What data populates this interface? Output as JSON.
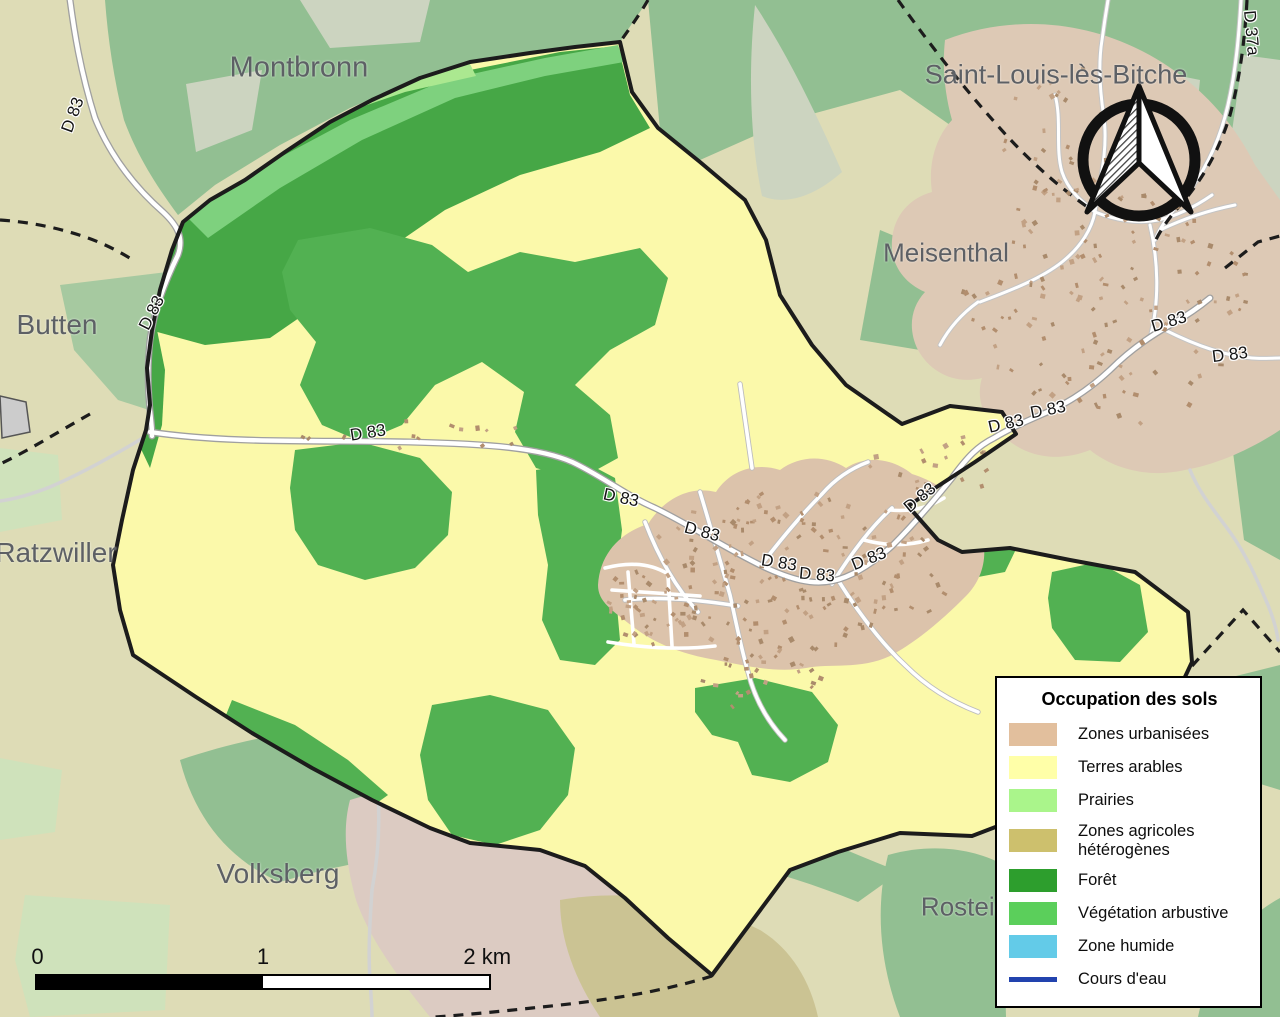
{
  "map": {
    "place_labels": {
      "montbronn": "Montbronn",
      "saint_louis": "Saint-Louis-lès-Bitche",
      "butten": "Butten",
      "meisenthal": "Meisenthal",
      "ratzwiller": "Ratzwiller",
      "volksberg": "Volksberg",
      "rosteig": "Rosteig"
    },
    "road_labels": {
      "d83": "D 83",
      "d37a": "D 37a"
    },
    "colors": {
      "commune_fill": "#fbf9aa",
      "forest": "#52b152",
      "forest_dark": "#46a746",
      "shrub": "#7ed17e",
      "prairie": "#abe890",
      "urban": "#dcc3ab",
      "building": "#b28e6e",
      "outside_base": "#dedcb6",
      "outside_green": "#92bf92",
      "outside_green_light": "#a6c9a0",
      "outside_pale": "#ccd4c0",
      "outside_mint": "#cfe2bb",
      "outside_pink": "#dccbc2",
      "outside_khaki": "#cbc393",
      "outside_urban": "#ddc9b5",
      "boundary": "#1c1c1c",
      "road_fill": "#ffffff",
      "road_casing": "#a0a0a0",
      "minor_road": "#d2d2d2"
    }
  },
  "legend": {
    "title": "Occupation des sols",
    "items": [
      {
        "label": "Zones urbanisées",
        "color": "#e2bf9d",
        "type": "fill"
      },
      {
        "label": "Terres arables",
        "color": "#ffffa8",
        "type": "fill"
      },
      {
        "label": "Prairies",
        "color": "#aaf58b",
        "type": "fill"
      },
      {
        "label": "Zones agricoles hétérogènes",
        "color": "#cdc06d",
        "type": "fill"
      },
      {
        "label": "Forêt",
        "color": "#2d9e2d",
        "type": "fill"
      },
      {
        "label": "Végétation arbustive",
        "color": "#5bcf5b",
        "type": "fill"
      },
      {
        "label": "Zone humide",
        "color": "#63cbe8",
        "type": "fill"
      },
      {
        "label": "Cours d'eau",
        "color": "#2243ae",
        "type": "line"
      }
    ]
  },
  "scalebar": {
    "labels": [
      "0",
      "1",
      "2 km"
    ]
  }
}
